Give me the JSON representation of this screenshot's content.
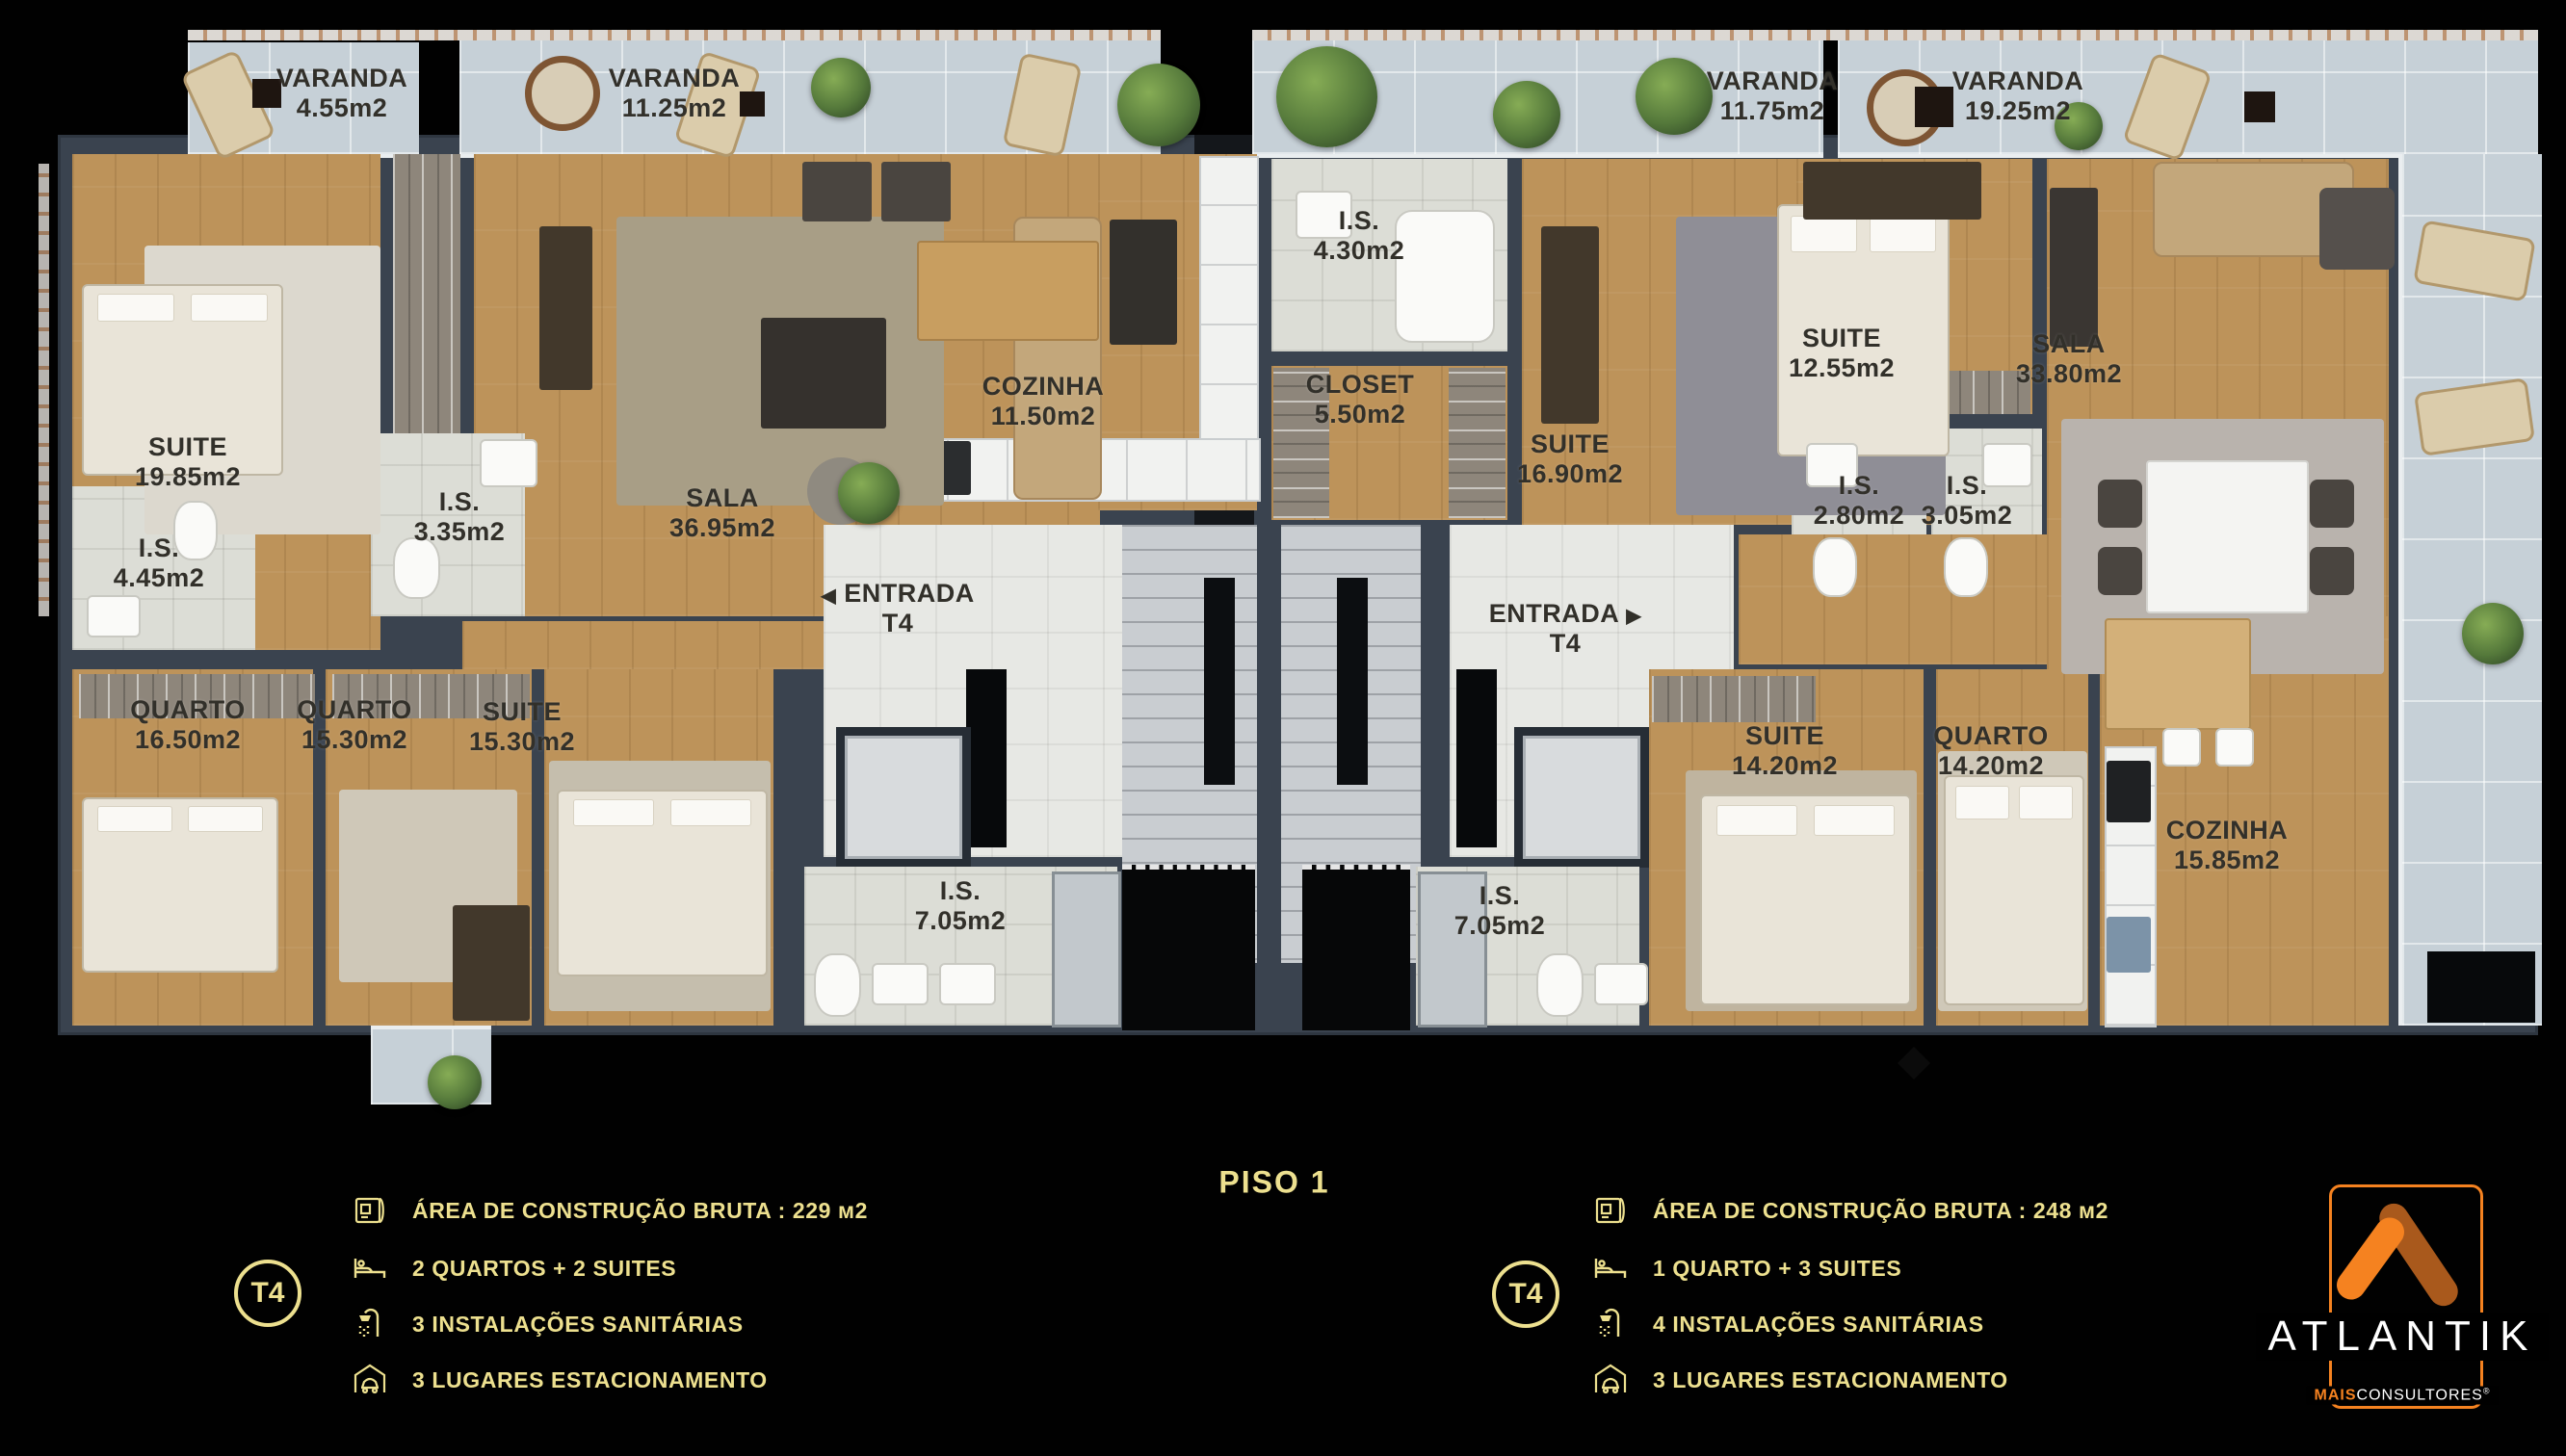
{
  "colors": {
    "accent_gold": "#EDE08F",
    "brand_orange": "#F58220",
    "brand_orange_dark": "#A9591C",
    "wall": "#3A434F"
  },
  "floor_title": "PISO 1",
  "plan": {
    "left_unit": {
      "varandas": [
        {
          "name": "VARANDA",
          "area": "4.55m2"
        },
        {
          "name": "VARANDA",
          "area": "11.25m2"
        }
      ],
      "rooms": [
        {
          "name": "SUITE",
          "area": "19.85m2"
        },
        {
          "name": "I.S.",
          "area": "4.45m2"
        },
        {
          "name": "I.S.",
          "area": "3.35m2"
        },
        {
          "name": "SALA",
          "area": "36.95m2"
        },
        {
          "name": "COZINHA",
          "area": "11.50m2"
        },
        {
          "name": "QUARTO",
          "area": "16.50m2"
        },
        {
          "name": "QUARTO",
          "area": "15.30m2"
        },
        {
          "name": "SUITE",
          "area": "15.30m2"
        },
        {
          "name": "I.S.",
          "area": "7.05m2"
        }
      ],
      "entrance": {
        "name": "ENTRADA",
        "unit": "T4",
        "arrow": "◀"
      }
    },
    "right_unit": {
      "varandas": [
        {
          "name": "VARANDA",
          "area": "11.75m2"
        },
        {
          "name": "VARANDA",
          "area": "19.25m2"
        }
      ],
      "rooms": [
        {
          "name": "I.S.",
          "area": "4.30m2"
        },
        {
          "name": "CLOSET",
          "area": "5.50m2"
        },
        {
          "name": "SUITE",
          "area": "16.90m2"
        },
        {
          "name": "SUITE",
          "area": "12.55m2"
        },
        {
          "name": "I.S.",
          "area": "2.80m2"
        },
        {
          "name": "I.S.",
          "area": "3.05m2"
        },
        {
          "name": "SALA",
          "area": "33.80m2"
        },
        {
          "name": "I.S.",
          "area": "7.05m2"
        },
        {
          "name": "SUITE",
          "area": "14.20m2"
        },
        {
          "name": "QUARTO",
          "area": "14.20m2"
        },
        {
          "name": "COZINHA",
          "area": "15.85m2"
        }
      ],
      "entrance": {
        "name": "ENTRADA",
        "unit": "T4",
        "arrow": "▶"
      }
    }
  },
  "legend_left": {
    "badge": "T4",
    "items": [
      {
        "icon": "blueprint-icon",
        "text": "ÁREA DE CONSTRUÇÃO BRUTA :  229 м2"
      },
      {
        "icon": "bed-icon",
        "text": "2 QUARTOS + 2 SUITES"
      },
      {
        "icon": "shower-icon",
        "text": "3 INSTALAÇÕES SANITÁRIAS"
      },
      {
        "icon": "garage-icon",
        "text": "3 LUGARES ESTACIONAMENTO"
      }
    ]
  },
  "legend_right": {
    "badge": "T4",
    "items": [
      {
        "icon": "blueprint-icon",
        "text": "ÁREA DE CONSTRUÇÃO BRUTA :  248 м2"
      },
      {
        "icon": "bed-icon",
        "text": "1 QUARTO + 3 SUITES"
      },
      {
        "icon": "shower-icon",
        "text": "4 INSTALAÇÕES SANITÁRIAS"
      },
      {
        "icon": "garage-icon",
        "text": "3 LUGARES ESTACIONAMENTO"
      }
    ]
  },
  "brand": {
    "name": "ATLANTIK",
    "mais": "MAIS",
    "consultores": "CONSULTORES",
    "reg": "®"
  }
}
